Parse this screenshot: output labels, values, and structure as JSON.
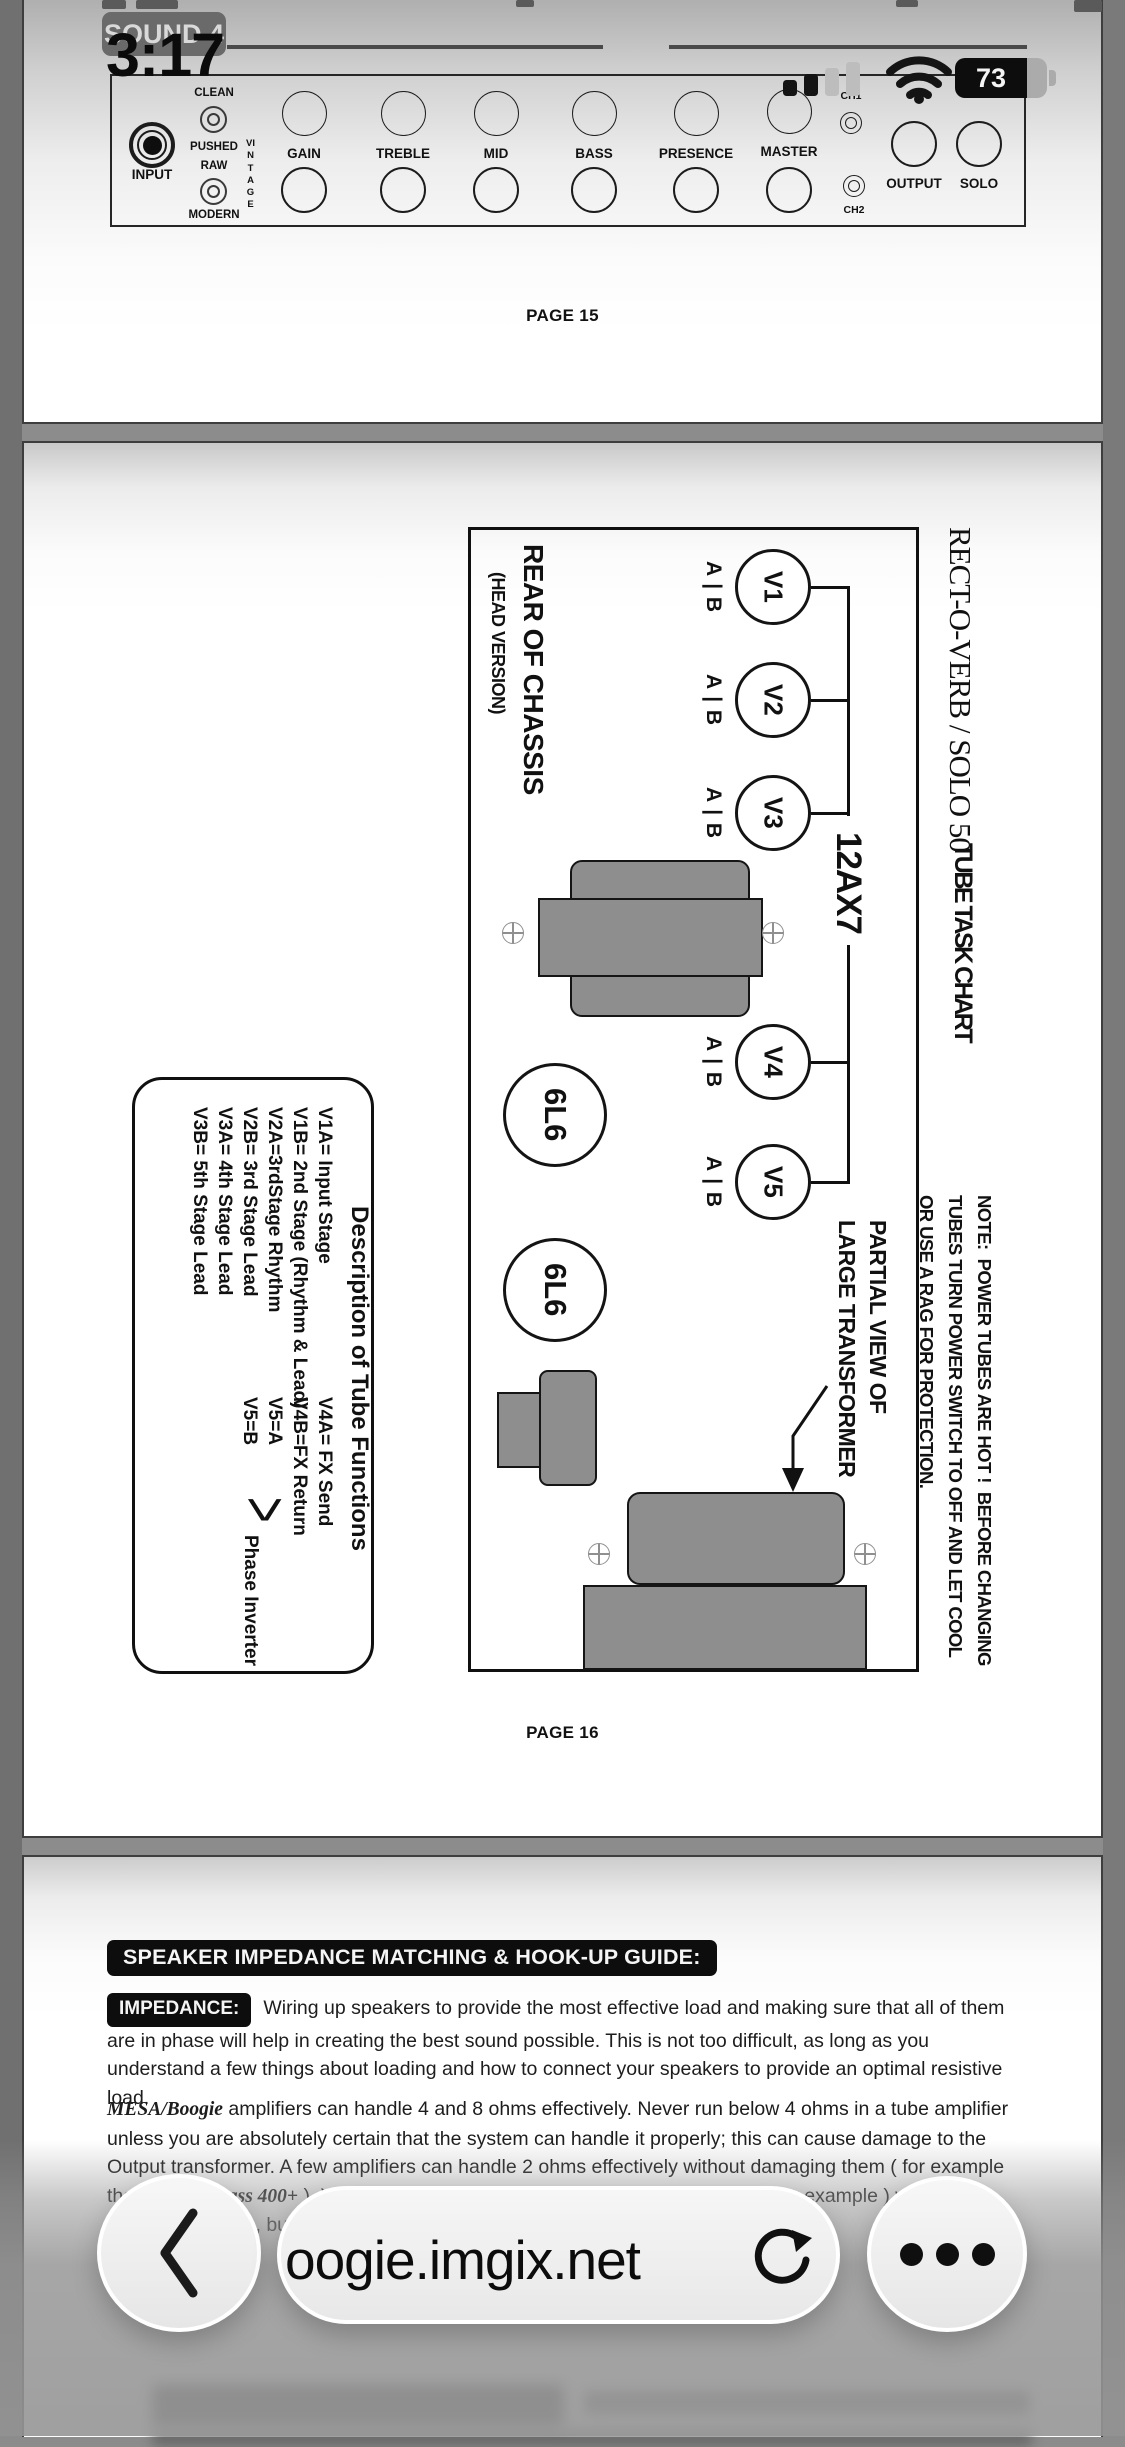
{
  "status_bar": {
    "time": "3:17",
    "battery_level": "73"
  },
  "doc": {
    "page15": {
      "sound_badge": "SOUND 4",
      "page_label": "PAGE 15",
      "panel": {
        "input": "INPUT",
        "clean": "CLEAN",
        "pushed": "PUSHED",
        "raw": "RAW",
        "modern": "MODERN",
        "vintage": "VINTAGE",
        "knobs": [
          "GAIN",
          "TREBLE",
          "MID",
          "BASS",
          "PRESENCE",
          "MASTER"
        ],
        "ch1": "CH1",
        "ch2": "CH2",
        "output": "OUTPUT",
        "solo": "SOLO"
      }
    },
    "page16": {
      "title": "RECT-O-VERB / SOLO 50",
      "subtitle": "TUBE TASK CHART",
      "rear": "REAR OF CHASSIS",
      "rear_sub": "(HEAD VERSION)",
      "tubes": [
        "V1",
        "V2",
        "V3",
        "V4",
        "V5"
      ],
      "ab": "A | B",
      "preamp_label": "12AX7",
      "power_tube": "6L6",
      "partial_line1": "PARTIAL VIEW OF",
      "partial_line2": "LARGE TRANSFORMER",
      "note1": "NOTE:  POWER TUBES ARE HOT !  BEFORE CHANGING",
      "note2": "TUBES TURN POWER SWITCH TO OFF AND LET COOL",
      "note3": "OR USE A RAG FOR PROTECTION.",
      "desc": {
        "title": "Description of Tube Functions",
        "left": [
          "V1A= Input Stage",
          "V1B= 2nd Stage (Rhythm & Lead)",
          "V2A=3rdStage Rhythm",
          "V2B= 3rd Stage Lead",
          "V3A= 4th Stage Lead",
          "V3B= 5th Stage Lead"
        ],
        "right": [
          "V4A= FX Send",
          "V4B=FX Return",
          "V5=A",
          "V5=B"
        ],
        "brace": ">",
        "phase": "Phase Inverter"
      },
      "page_label": "PAGE 16"
    },
    "page17": {
      "heading": "SPEAKER IMPEDANCE MATCHING & HOOK-UP GUIDE:",
      "impedance_badge": "IMPEDANCE:",
      "impedance_text": "Wiring up speakers to provide the most effective load and making sure that all of them are in phase will help in creating the best sound possible. This is not too difficult, as long as you understand a few things about loading and how to connect your speakers to provide an optimal resistive load.",
      "brand": "MESA/Boogie",
      "body_a": " amplifiers can handle 4 and 8 ohms effectively. Never run below 4 ohms in a tube amplifier unless you are absolutely certain that the system can handle it properly; this can cause damage to the Output transformer. A few amplifiers can handle 2 ohms effectively without damaging them ( for example the ",
      "brand2": "MESA'S Bass 400+",
      "body_b": " ). You can always have a higher resistance ( 16 ohms, for example ) without damaging results, but too low of a resistance will likely cause problems."
    }
  },
  "toolbar": {
    "url": "oogie.imgix.net"
  },
  "colors": {
    "canvas_bg": "#8c8c8c",
    "badge_bg": "#0d0d0d",
    "transformer_gray": "#8e8e8e",
    "accent_dark": "#101010"
  }
}
